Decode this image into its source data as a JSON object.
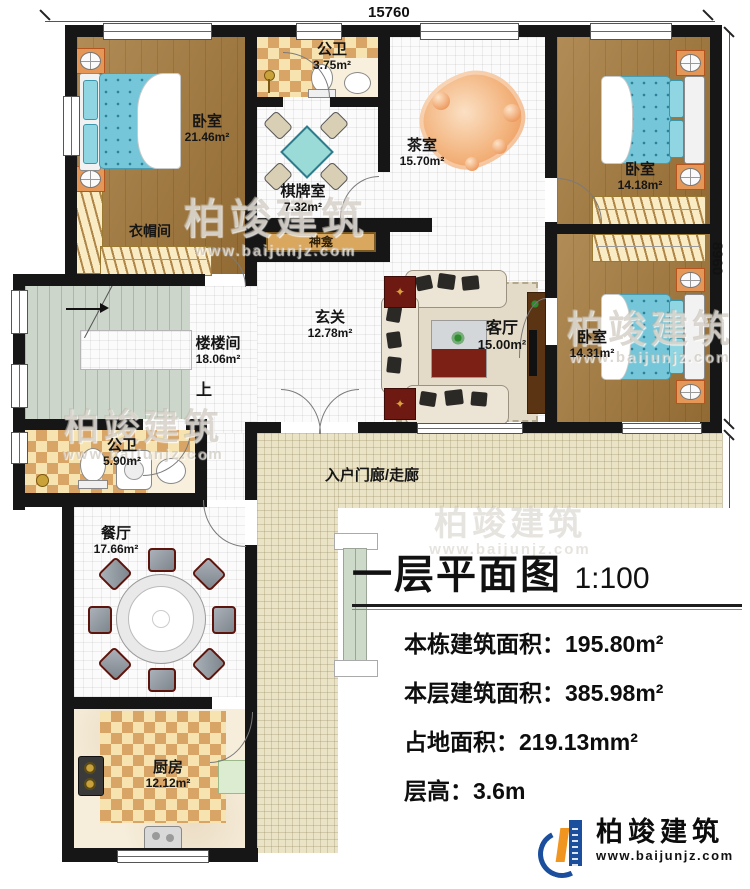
{
  "plan": {
    "rooms": {
      "bedroom_tl": {
        "name": "卧室",
        "area": "21.46m²"
      },
      "bath_top": {
        "name": "公卫",
        "area": "3.75m²"
      },
      "chess_room": {
        "name": "棋牌室",
        "area": "7.32m²"
      },
      "tea_room": {
        "name": "茶室",
        "area": "15.70m²"
      },
      "bedroom_tr": {
        "name": "卧室",
        "area": "14.18m²"
      },
      "stair_hall": {
        "name": "楼楼间",
        "area": "18.06m²"
      },
      "foyer": {
        "name": "玄关",
        "area": "12.78m²"
      },
      "living_room": {
        "name": "客厅",
        "area": "15.00m²"
      },
      "bedroom_br": {
        "name": "卧室",
        "area": "14.31m²"
      },
      "bath_mid": {
        "name": "公卫",
        "area": "5.90m²"
      },
      "dining_room": {
        "name": "餐厅",
        "area": "17.66m²"
      },
      "kitchen": {
        "name": "厨房",
        "area": "12.12m²"
      }
    },
    "labels": {
      "cloakroom": "衣帽间",
      "shrine": "神龛",
      "up": "上",
      "porch": "入户门廊/走廊"
    },
    "dimensions": {
      "top": "15760",
      "right_upper": "8960",
      "right_lower": "9800"
    }
  },
  "title_block": {
    "title": "一层平面图",
    "scale": "1:100",
    "rows": [
      {
        "label": "本栋建筑面积：",
        "value": "195.80m²"
      },
      {
        "label": "本层建筑面积：",
        "value": "385.98m²"
      },
      {
        "label": "占地面积：",
        "value": "219.13mm²"
      },
      {
        "label": "层高：",
        "value": "3.6m"
      }
    ]
  },
  "brand": {
    "name": "柏竣建筑",
    "website": "www.baijunjz.com"
  },
  "watermark": {
    "name": "柏竣建筑",
    "website": "www.baijunjz.com"
  },
  "colors": {
    "wall": "#161616",
    "wood_floor": "#a5793a",
    "tile_floor": "#fbfbfb",
    "checker": "#d9a566",
    "porch": "#ebe3c6",
    "stair": "#ccd6ca",
    "bed_blue": "#74c6d8",
    "rug_orange": "#ef9a5e",
    "brand_blue": "#1b4f9e",
    "brand_orange": "#f0951f"
  }
}
